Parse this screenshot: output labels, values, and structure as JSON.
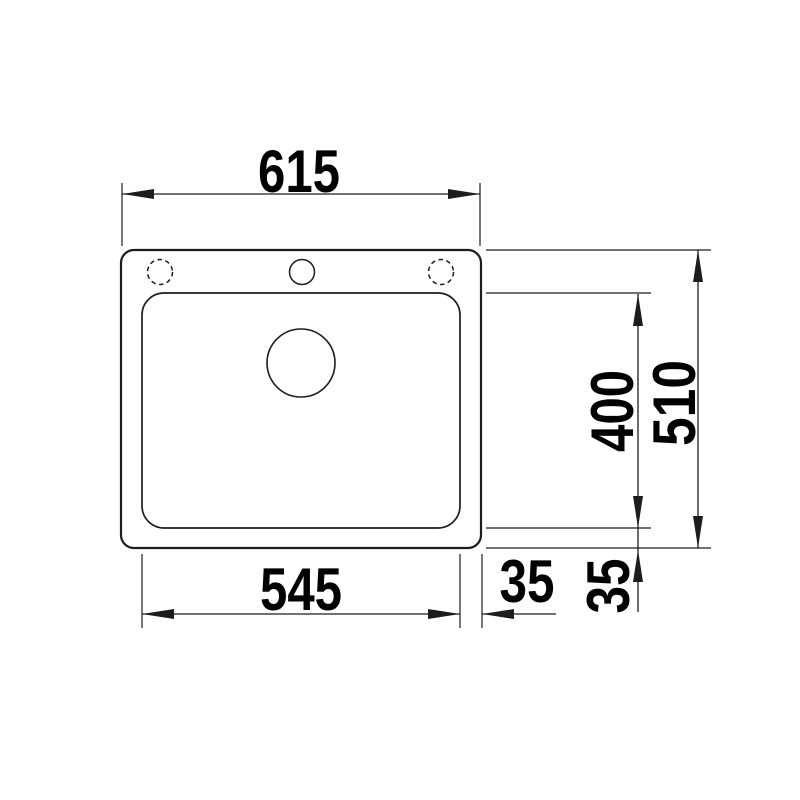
{
  "drawing": {
    "subject": "sink-top-view-technical-drawing",
    "ink_color": "#1d1d1b",
    "background_color": "#ffffff",
    "dimensions": {
      "overall_width": "615",
      "overall_depth": "510",
      "basin_width": "545",
      "basin_depth": "400",
      "basin_to_edge_right": "35",
      "basin_to_edge_bottom": "35"
    }
  }
}
